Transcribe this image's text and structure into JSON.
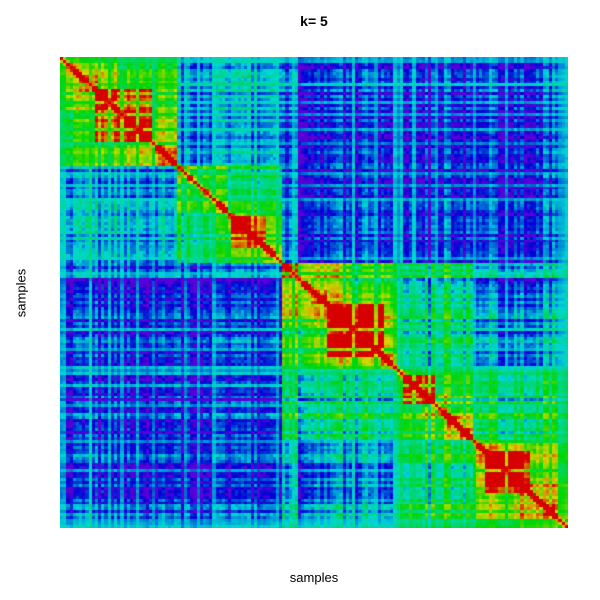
{
  "title": "k= 5",
  "axes": {
    "x_label": "samples",
    "y_label": "samples"
  },
  "chart_data": {
    "type": "heatmap",
    "subtype": "consensus-matrix",
    "title": "k= 5",
    "xlabel": "samples",
    "ylabel": "samples",
    "k": 5,
    "n_samples": 160,
    "value_range": [
      0,
      1
    ],
    "diagonal_value": 1.0,
    "legend": "none",
    "grid": "off",
    "colormap": {
      "name": "rainbow-violet-to-red",
      "hue_start_deg": 270,
      "hue_end_deg": 0,
      "saturation": 1.0,
      "brightness": 0.84,
      "stops": [
        "#6B00D6",
        "#1A1AD6",
        "#00D6D6",
        "#00D655",
        "#7FD600",
        "#D6D600",
        "#D66A00",
        "#D60000"
      ]
    },
    "clusters": [
      {
        "id": 1,
        "size": 37,
        "hot_range": [
          0.3,
          0.8
        ],
        "hot_boost": 0.32
      },
      {
        "id": 2,
        "size": 33,
        "hot_range": [
          0.52,
          0.85
        ],
        "hot_boost": 0.28
      },
      {
        "id": 3,
        "size": 36,
        "hot_range": [
          0.38,
          0.9
        ],
        "hot_boost": 0.4
      },
      {
        "id": 4,
        "size": 24,
        "hot_range": [
          0.08,
          0.48
        ],
        "hot_boost": 0.38
      },
      {
        "id": 5,
        "size": 30,
        "hot_range": [
          0.12,
          0.6
        ],
        "hot_boost": 0.32
      }
    ],
    "consensus_between_clusters": [
      [
        0.56,
        0.27,
        0.14,
        0.1,
        0.14
      ],
      [
        0.27,
        0.4,
        0.15,
        0.11,
        0.13
      ],
      [
        0.14,
        0.15,
        0.6,
        0.42,
        0.26
      ],
      [
        0.1,
        0.11,
        0.42,
        0.55,
        0.46
      ],
      [
        0.14,
        0.13,
        0.26,
        0.46,
        0.64
      ]
    ],
    "texture": {
      "seed": 21,
      "sub1_splits": [
        2,
        3
      ],
      "sub2_splits": [
        5,
        8
      ],
      "sub_boost1": 0.11,
      "sub_boost2": 0.12,
      "proximity_boost": 0.05,
      "sample_noise_amp": 0.12,
      "dark_streak_probability": 0.06,
      "dark_streak_offset": -0.12,
      "group_noise_amp": 0.055,
      "pair_noise_amp": 0.045,
      "streak_probability": 0.09,
      "streak_value": 0.42,
      "forced_streak_samples": [
        0,
        1,
        9,
        68,
        105,
        106,
        157,
        158,
        159
      ],
      "near_diagonal_boost": 0.22,
      "min_value": 0.02
    },
    "plot_rect": {
      "left": 60,
      "top": 57,
      "width": 508,
      "height": 471
    }
  }
}
